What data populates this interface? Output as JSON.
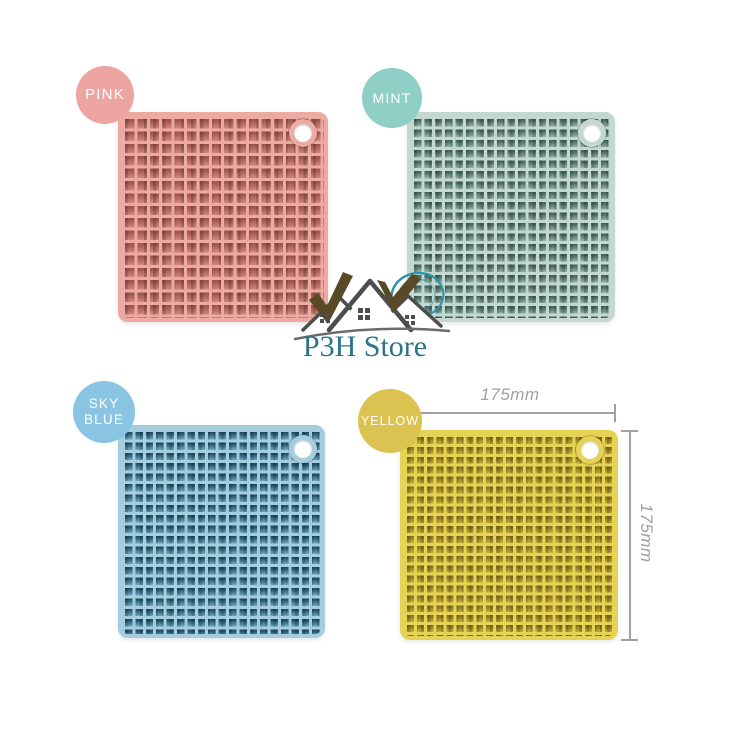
{
  "brand": {
    "name": "P3H Store",
    "color": "#2b7389"
  },
  "products": [
    {
      "label": "PINK",
      "badge_color": "#eca5a0",
      "mat": {
        "ridge": "#edaaa2",
        "cell_dark": "#9c544d",
        "cell_mid": "#d4867e",
        "pitch_px": 12.4
      }
    },
    {
      "label": "MINT",
      "badge_color": "#90cfc5",
      "mat": {
        "ridge": "#c3d8d0",
        "cell_dark": "#44655b",
        "cell_mid": "#93b3a9",
        "pitch_px": 10.4
      }
    },
    {
      "label": "SKY BLUE",
      "badge_color": "#89c4e2",
      "mat": {
        "ridge": "#a5cde0",
        "cell_dark": "#1e4f68",
        "cell_mid": "#6fa8c0",
        "pitch_px": 10.4
      }
    },
    {
      "label": "YELLOW",
      "badge_color": "#dcc251",
      "mat": {
        "ridge": "#e6d255",
        "cell_dark": "#8a761d",
        "cell_mid": "#c9b136",
        "pitch_px": 9.9
      }
    }
  ],
  "dimensions": {
    "width_label": "175mm",
    "height_label": "175mm",
    "line_color": "#a0a0a0"
  }
}
